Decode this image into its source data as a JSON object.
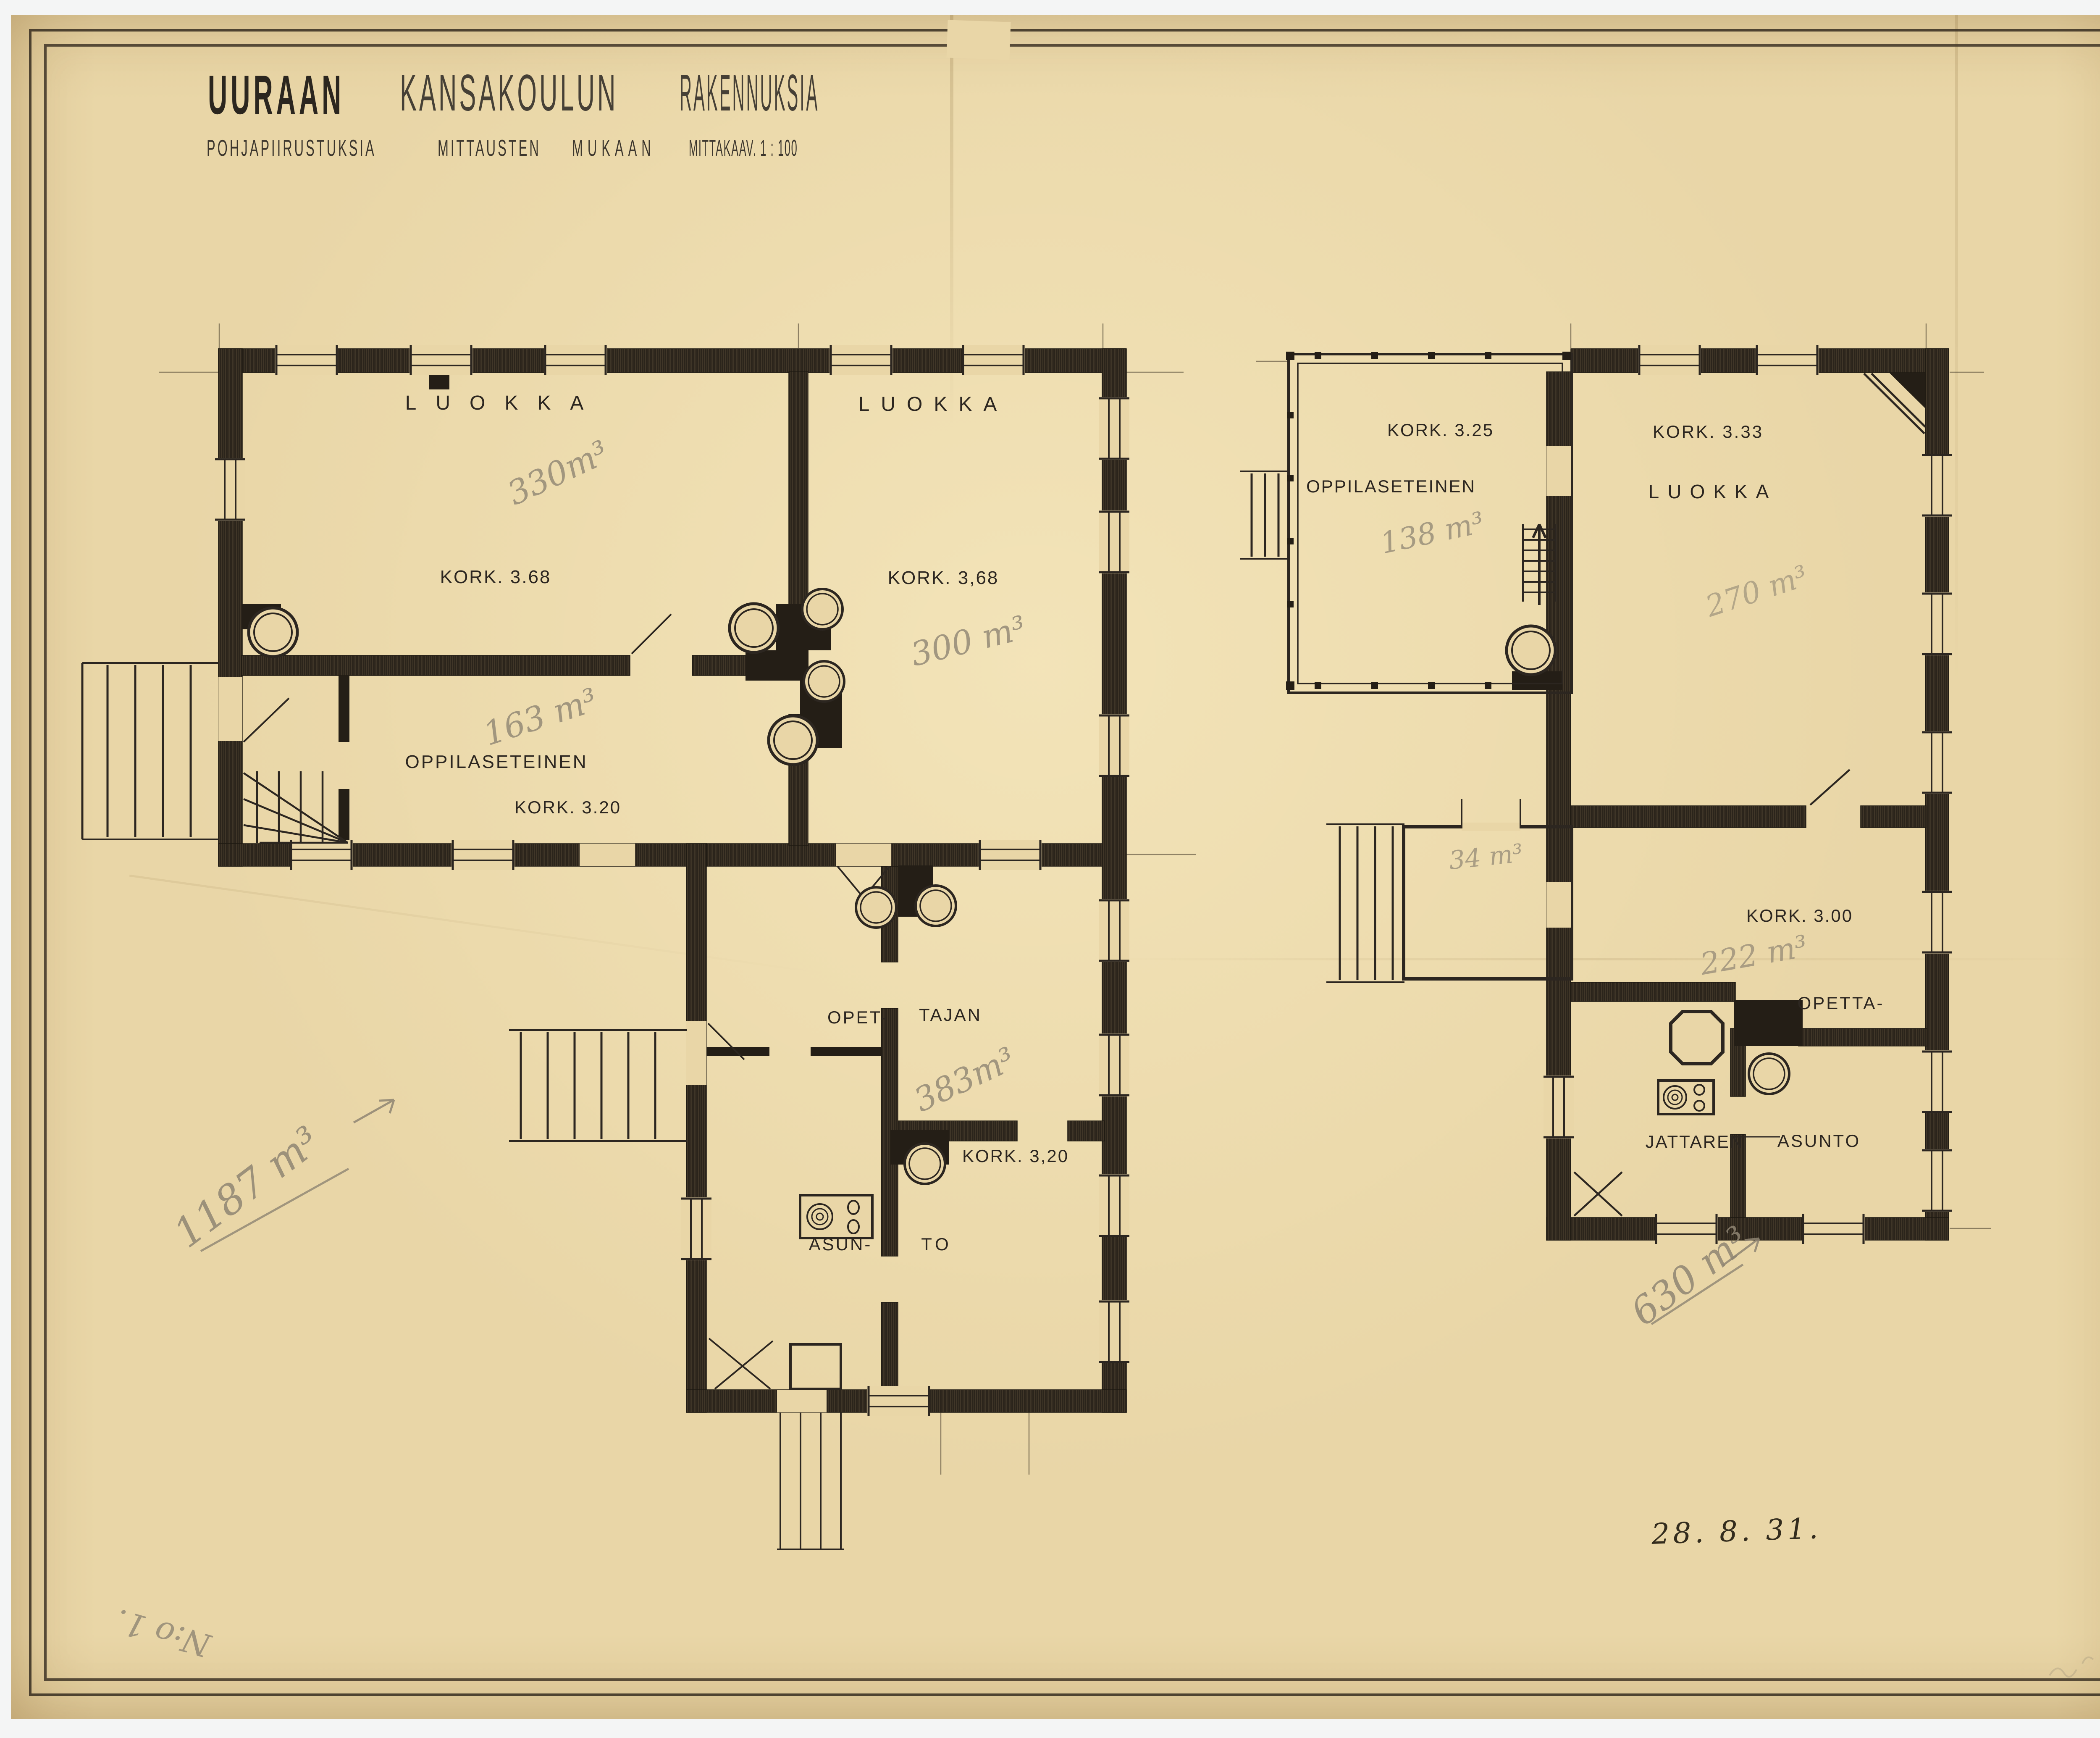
{
  "sheet": {
    "title_words": [
      "UURAAN",
      "KANSAKOULUN",
      "RAKENNUKSIA"
    ],
    "subtitle_words": [
      "POHJAPIIRUSTUKSIA",
      "MITTAUSTEN",
      "MUKAAN",
      "MITTAKAAV. 1 : 100"
    ],
    "date_note": "28. 8. 31.",
    "corner_note": "N:o 1."
  },
  "left_plan": {
    "classroom1_label": "LUOKKA",
    "classroom1_height": "KORK. 3.68",
    "classroom1_volume": "330m³",
    "classroom2_label": "LUOKKA",
    "classroom2_height": "KORK. 3,68",
    "classroom2_volume": "300 m³",
    "hall_label": "OPPILASETEINEN",
    "hall_height": "KORK. 3.20",
    "hall_volume": "163 m³",
    "teacher_label_1": "OPET-",
    "teacher_label_2": "TAJAN",
    "teacher_volume": "383m³",
    "teacher_height": "KORK. 3,20",
    "apartment_label_1": "ASUN-",
    "apartment_label_2": "TO",
    "total_volume": "1187 m³"
  },
  "right_plan": {
    "hall_height": "KORK. 3.25",
    "hall_label": "OPPILASETEINEN",
    "hall_volume": "138 m³",
    "classroom_height": "KORK. 3.33",
    "classroom_label": "LUOKKA",
    "classroom_volume": "270 m³",
    "room_height": "KORK. 3.00",
    "room_volume": "222 m³",
    "teacher_label_1": "OPETTA-",
    "teacher_label_2": "JATTAREN",
    "teacher_label_3": "ASUNTO",
    "annex_volume": "34 m³",
    "total_volume": "630 m³"
  },
  "colors": {
    "paper": "#e9d6a7",
    "ink": "#2c2620",
    "pencil": "#8f8573"
  }
}
